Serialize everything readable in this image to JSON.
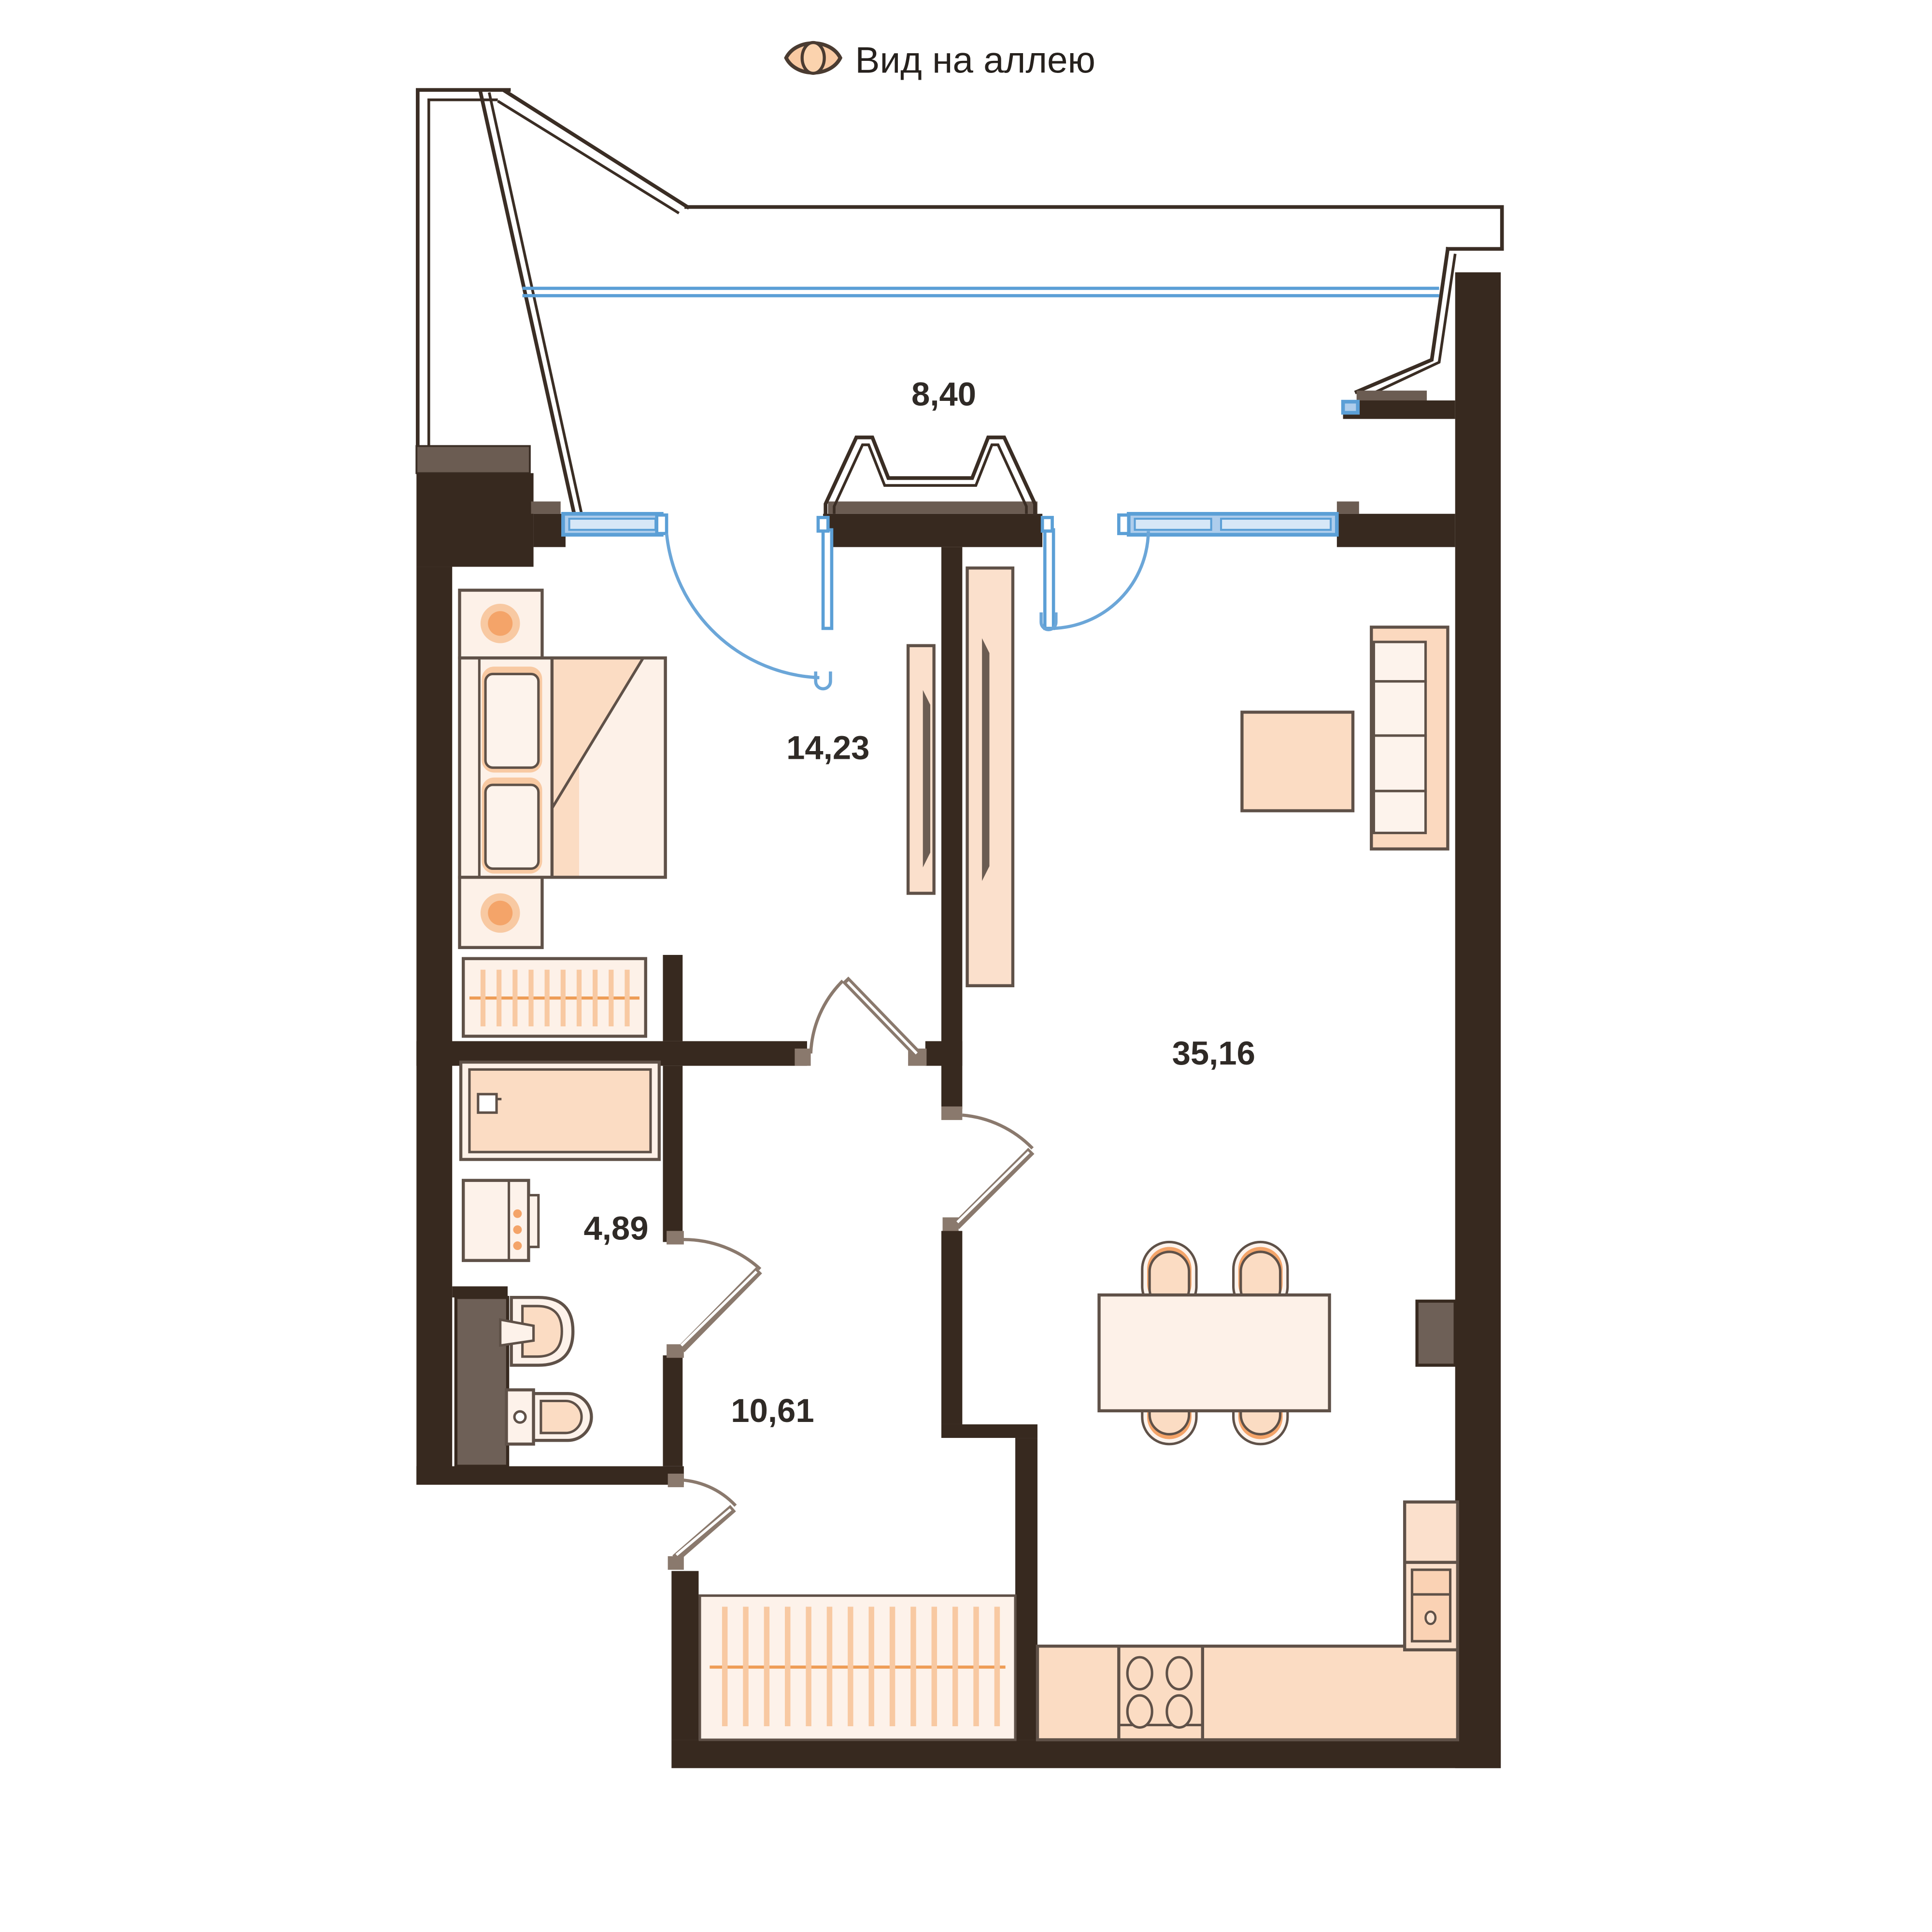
{
  "header": {
    "title": "Вид на аллею",
    "icon": "eye-icon"
  },
  "rooms": [
    {
      "name": "balcony",
      "area": "8,40"
    },
    {
      "name": "bedroom",
      "area": "14,23"
    },
    {
      "name": "living-kitchen",
      "area": "35,16"
    },
    {
      "name": "bathroom",
      "area": "4,89"
    },
    {
      "name": "hallway",
      "area": "10,61"
    }
  ],
  "colors": {
    "wall": "#37291F",
    "wall_secondary": "#6B5C52",
    "furniture_light": "#FDF1E8",
    "furniture_peach": "#FBDCC3",
    "accent_orange": "#F4A469",
    "window_blue": "#5B9FD6",
    "door_gray": "#8A796D",
    "text": "#2F2A26"
  }
}
